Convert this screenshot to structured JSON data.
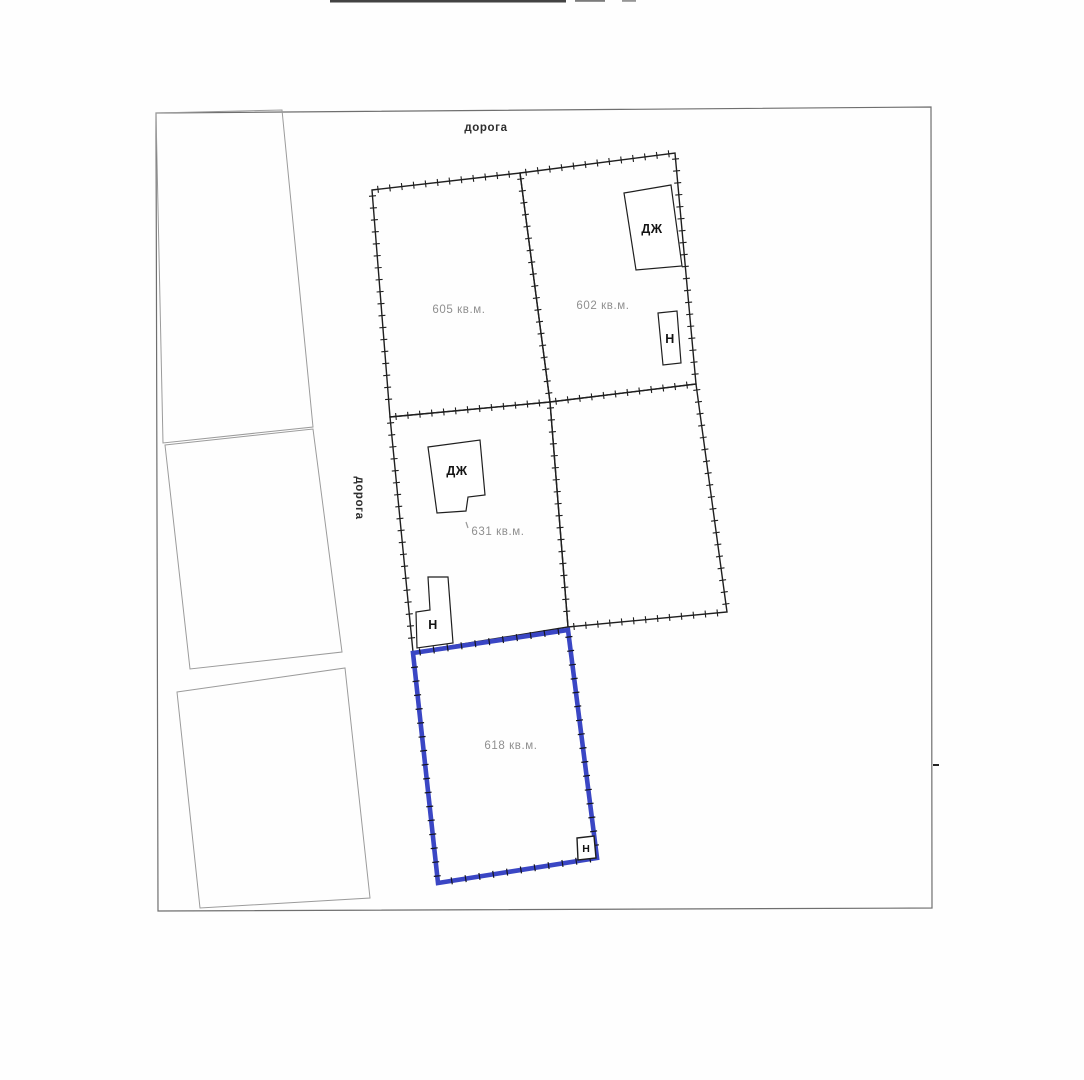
{
  "road_labels": {
    "top": "дорога",
    "left": "дорога"
  },
  "parcels": {
    "p605": {
      "area": "605 кв.м."
    },
    "p602": {
      "area": "602 кв.м."
    },
    "p631": {
      "area": "631 кв.м."
    },
    "p618": {
      "area": "618 кв.м.",
      "highlighted": true
    }
  },
  "buildings": {
    "dzh": "ДЖ",
    "n": "Н"
  },
  "colors": {
    "highlight_blue": "#3a46c4",
    "parcel_line_black": "#1f1f1f",
    "faint_parcel_gray": "#9b9b9b",
    "page_border_gray": "#6f6f6f",
    "area_text_gray": "#8f8f8f"
  }
}
